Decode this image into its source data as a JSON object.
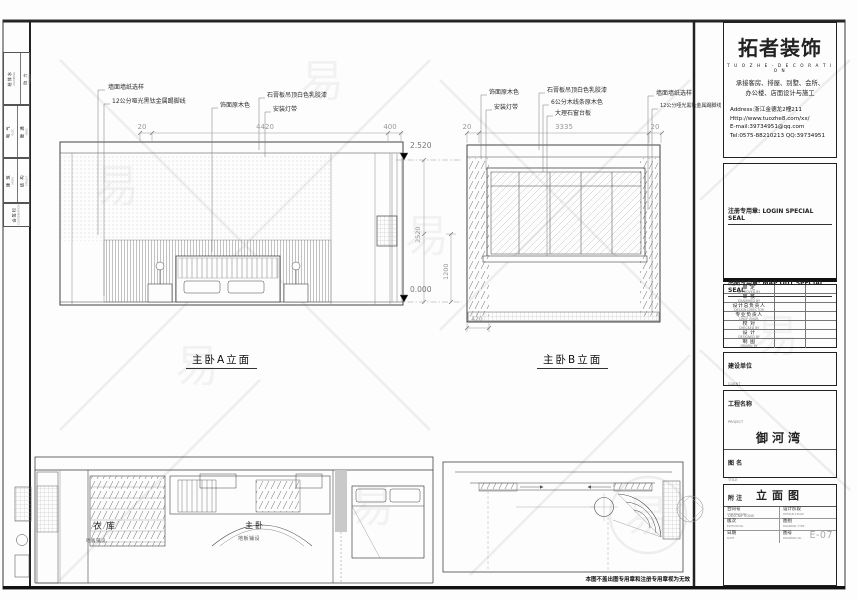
{
  "watermark": {
    "glyph": "易"
  },
  "sidebar": {
    "groups": [
      {
        "a": "给排水",
        "a_en": "PLUMBING",
        "b": "动 力",
        "b_en": "POWER"
      },
      {
        "a": "电 气",
        "a_en": "ELEC.",
        "b": "暖 通",
        "b_en": "HVAC"
      },
      {
        "a": "建 筑",
        "a_en": "ARCH.",
        "b": "结 构",
        "b_en": "STRUCT."
      },
      {
        "a": "会签栏",
        "a_en": "COORDINATION"
      }
    ]
  },
  "elev_a": {
    "title": "主卧A立面",
    "callouts": [
      "墙面墙纸选样",
      "12公分哑光黑钛金属踢脚线",
      "饰面原木色",
      "石膏板吊顶白色乳胶漆",
      "安装灯带"
    ],
    "dims_top": [
      "20",
      "4420",
      "400"
    ],
    "level_top": "2.520",
    "level_bottom": "0.000",
    "dim_height": "2520",
    "dim_height2": "1200"
  },
  "elev_b": {
    "title": "主卧B立面",
    "callouts_left": [
      "饰面原木色",
      "安装灯带"
    ],
    "callouts_mid": [
      "石膏板吊顶白色乳胶漆",
      "6公分木线条原木色",
      "大理石窗台板"
    ],
    "callouts_right": [
      "墙面墙纸选样",
      "12公分哑光黑钛金属踢脚线"
    ],
    "dims_top": [
      "20",
      "3335",
      "20"
    ],
    "dim_bottom": "420"
  },
  "plan": {
    "room_a": "衣库",
    "room_a_note": "地板铺设",
    "room_b": "主卧",
    "room_b_note": "地板铺设"
  },
  "footer": {
    "note": "本图不盖出图专用章和注册专用章视为无效"
  },
  "titleblock": {
    "logo": "拓者装饰",
    "logo_en": "T U O Z H E - D E C O R A T I O N",
    "services1": "承接客房、排屋、别墅、会所、",
    "services2": "办公楼、店面设计与施工",
    "address": "Address:浙江金德龙2幢211",
    "website": "Http://www.tuozhe8.com/xx/",
    "email": "E-mail:39734951@qq.com",
    "tel": "Tel:0575-88210213   QQ:39734951",
    "seal_register": "注册专用章: LOGIN SPECIAL SEAL",
    "seal_mapout": "出图专用章: MAP OUT SPECIAL SEAL",
    "personnel": [
      {
        "cn": "审 定",
        "en": "APPROVED BY"
      },
      {
        "cn": "审 核",
        "en": "EXAMINED BY"
      },
      {
        "cn": "设计总负责人",
        "en": "DESIGN DIRECTOR"
      },
      {
        "cn": "专业负责人",
        "en": "CHIEF ENGR."
      },
      {
        "cn": "校 对",
        "en": "CHECKED BY"
      },
      {
        "cn": "设 计",
        "en": "DESIGNED BY"
      },
      {
        "cn": "制 图",
        "en": "DRAWN BY"
      }
    ],
    "client_cn": "建设单位",
    "client_en": "CLIENT",
    "project_cn": "工程名称",
    "project_en": "PROJECT",
    "project_name": "御河湾",
    "title_cn": "图 名",
    "title_en": "TITLE",
    "title_value": "立面图",
    "fields": [
      {
        "cn": "合同号",
        "en": "CONTRACT No.",
        "value": ""
      },
      {
        "cn": "设计阶段",
        "en": "DESIGN STAGE",
        "value": ""
      },
      {
        "cn": "版次",
        "en": "EDITION No.",
        "value": ""
      },
      {
        "cn": "图别",
        "en": "DRAWING TYPE",
        "value": ""
      },
      {
        "cn": "日期",
        "en": "DATE",
        "value": ""
      },
      {
        "cn": "图号",
        "en": "DRAWING No.",
        "value": "E-07"
      }
    ],
    "notes_cn": "附 注",
    "notes_en": "DESCRIPTIONS"
  }
}
